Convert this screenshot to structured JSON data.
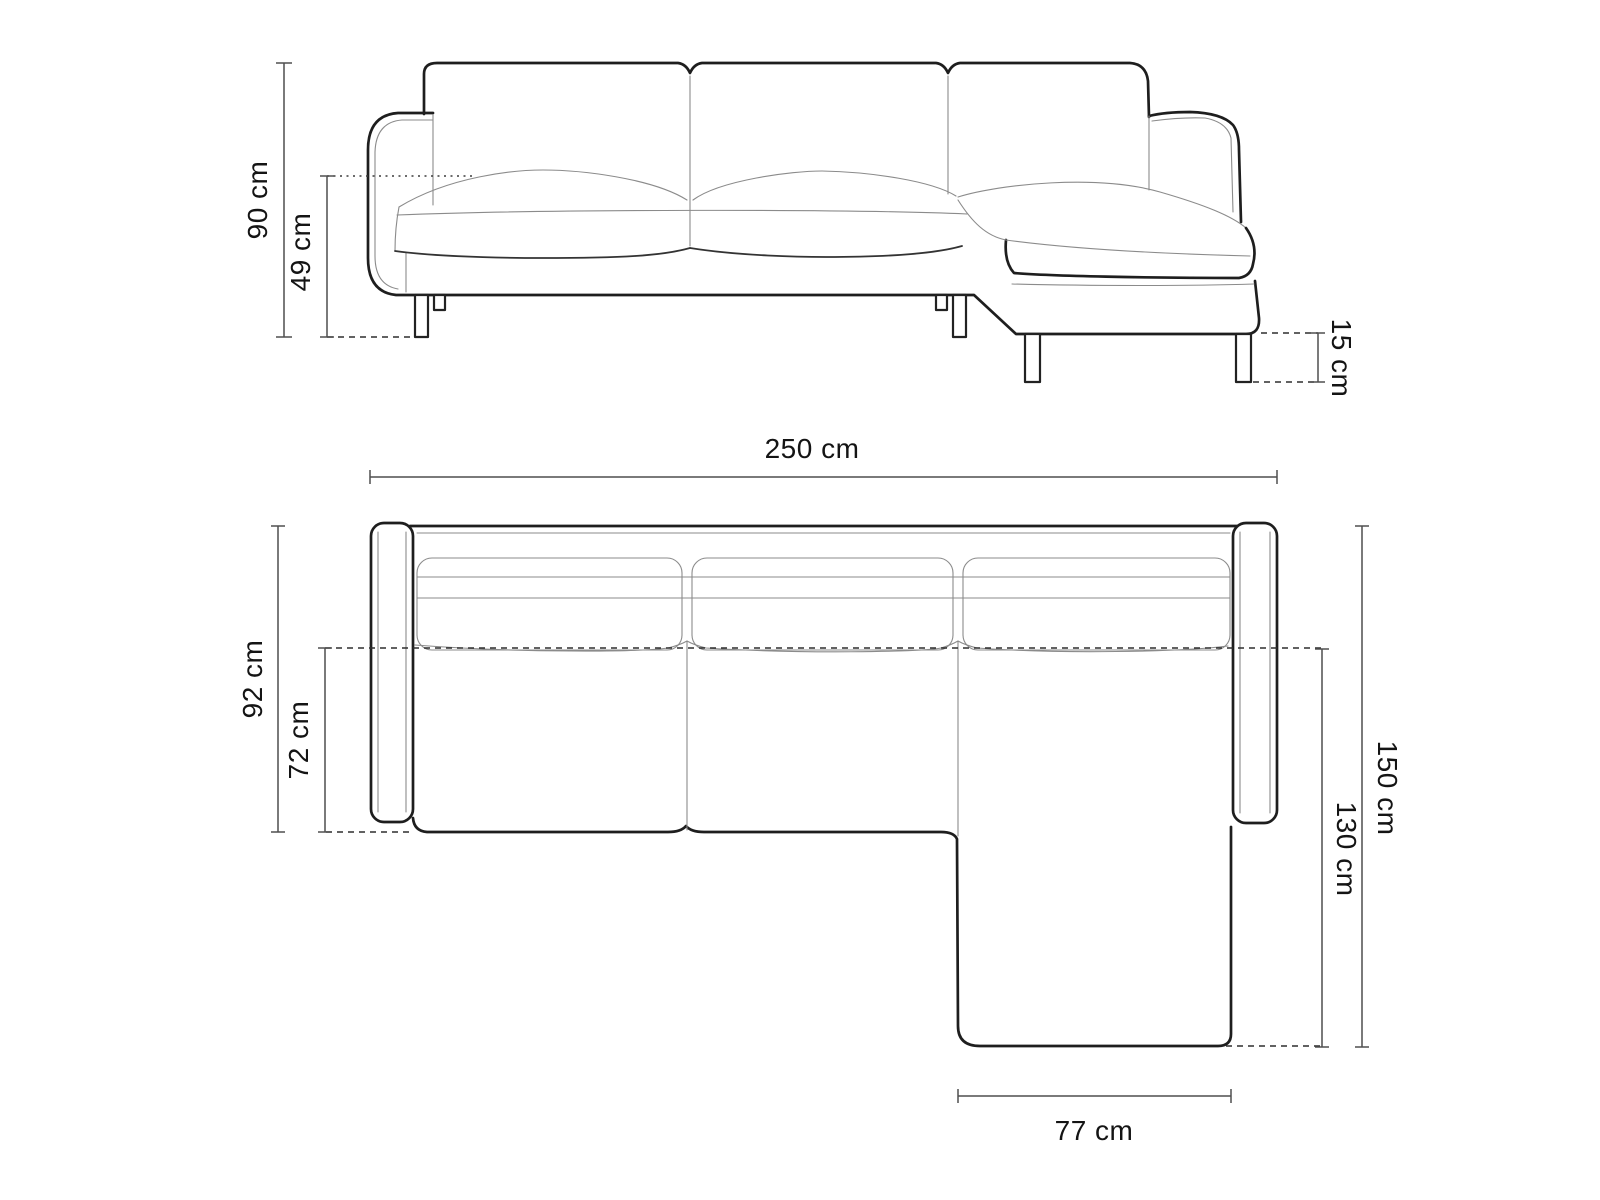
{
  "diagram": {
    "kind": "corner-sofa-dimension-drawing",
    "unit": "cm"
  },
  "dimensions": {
    "front": {
      "total_height": "90 cm",
      "seat_height": "49 cm",
      "leg_height": "15 cm"
    },
    "plan": {
      "total_width": "250 cm",
      "total_depth": "92 cm",
      "seat_depth": "72 cm",
      "chaise_total_length": "150 cm",
      "chaise_length": "130 cm",
      "chaise_width": "77 cm"
    }
  },
  "colors": {
    "background": "#ffffff",
    "outline_strong": "#1e1e1e",
    "outline_thin": "#8b8b8b",
    "dimension_line": "#4f4f4f",
    "dashed_line": "#2e2e2e",
    "label_text": "#141414"
  }
}
